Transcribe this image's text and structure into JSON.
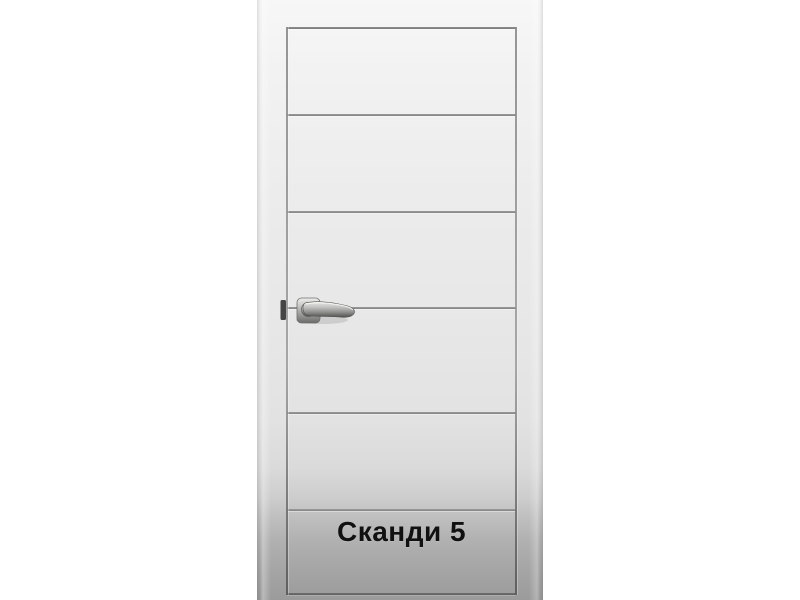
{
  "product": {
    "label": "Сканди 5"
  },
  "photo": {
    "subject": "white interior door with five horizontal grooves and chrome lever handle",
    "background_color": "#ffffff",
    "door_color_top": "#f7f7f7",
    "door_color_bottom": "#9b9b9b",
    "groove_color": "#828282",
    "handle_metal_color": "#b8b8b6",
    "label_color": "#111111"
  }
}
